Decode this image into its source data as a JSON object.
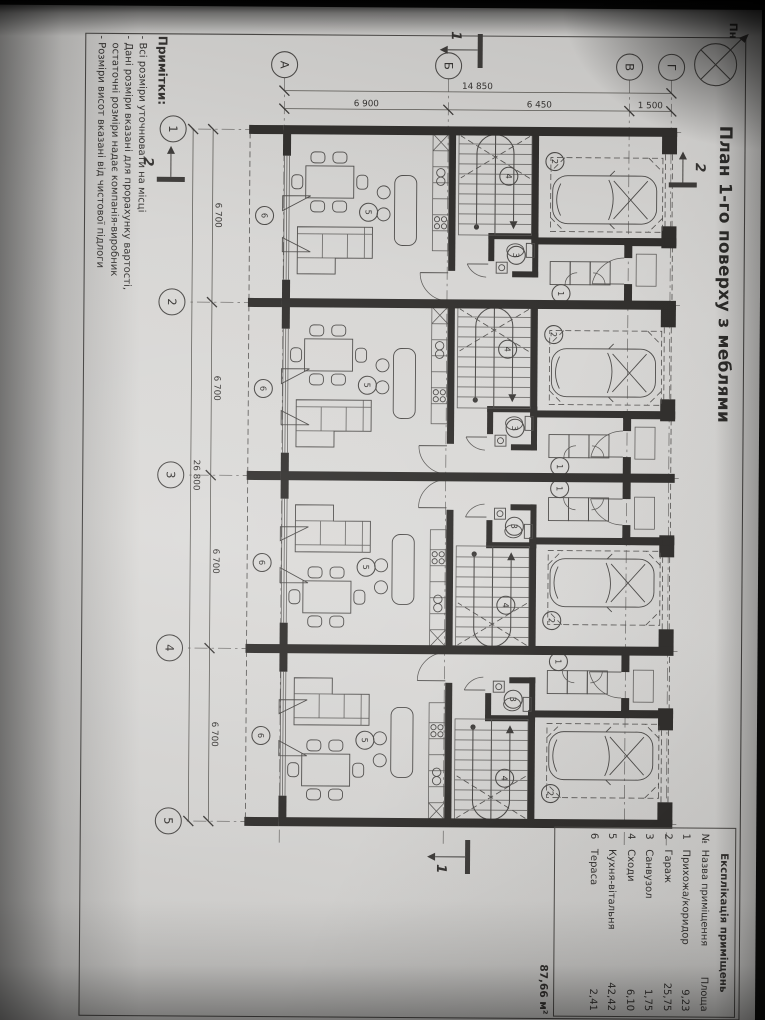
{
  "title": "План 1-го поверху з меблями",
  "north": {
    "label": "Пн"
  },
  "axes": {
    "letters": [
      "Г",
      "В",
      "Б",
      "А"
    ],
    "numbers": [
      "1",
      "2",
      "3",
      "4",
      "5"
    ]
  },
  "dims": {
    "total_depth": "14 850",
    "seg_vg": "1 500",
    "seg_bv": "6 450",
    "seg_ab": "6 900",
    "unit_width": "6 700",
    "total_width": "26 800"
  },
  "sections": {
    "one": "1",
    "two": "2"
  },
  "rooms": {
    "r1": "1",
    "r2": "2",
    "r3": "3",
    "r4": "4",
    "r5": "5",
    "r6": "6"
  },
  "explication": {
    "title": "Експлікація приміщень",
    "columns": {
      "no": "№",
      "name": "Назва приміщення",
      "area": "Площа"
    },
    "rows": [
      {
        "no": "1",
        "name": "Прихожа/коридор",
        "area": "9,23"
      },
      {
        "no": "2",
        "name": "Гараж",
        "area": "25,75"
      },
      {
        "no": "3",
        "name": "Санвузол",
        "area": "1,75"
      },
      {
        "no": "4",
        "name": "Сходи",
        "area": "6,10"
      },
      {
        "no": "5",
        "name": "Кухня-вітальня",
        "area": "42,42"
      },
      {
        "no": "6",
        "name": "Тераса",
        "area": "2,41"
      }
    ],
    "total": "87,66 м²"
  },
  "notes": {
    "heading": "Примітки:",
    "lines": [
      "- Всі розміри уточнювати на місці",
      "- Дані розміри вказані для прорахунку вартості,",
      "остаточні розміри надає компанія-виробник",
      "- Розміри висот вказані від чистової підлоги"
    ]
  }
}
